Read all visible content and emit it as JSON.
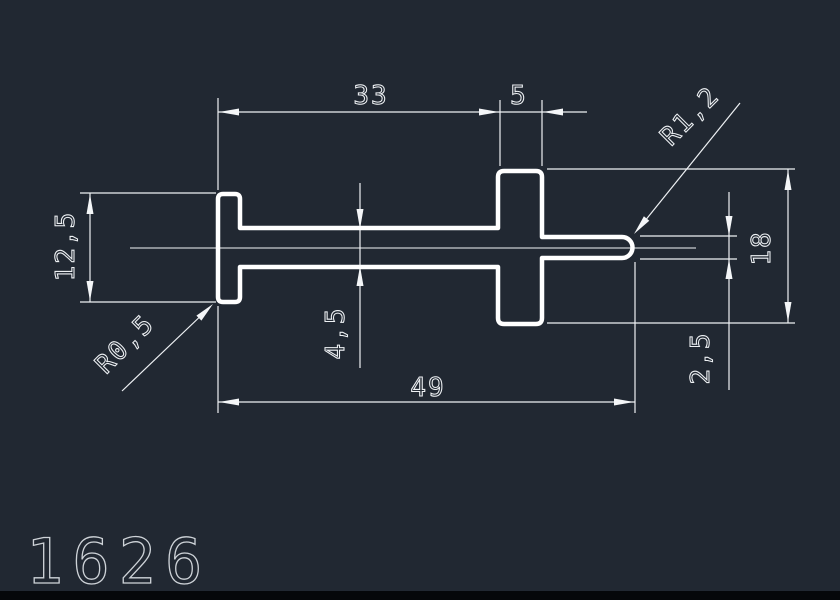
{
  "app": {
    "background_color": "#212832",
    "line_color": "#ffffff",
    "dim_color": "#eef1f4",
    "footer_color": "#05070a"
  },
  "drawing": {
    "part_number": "1626",
    "dimensions": {
      "top_segment_width": "33",
      "tab_width": "5",
      "overall_width": "49",
      "flange_height": "12,5",
      "web_thickness": "4,5",
      "tab_height": "18",
      "tip_thickness": "2,5",
      "flange_corner_radius": "R0,5",
      "tip_radius": "R1,2"
    }
  }
}
